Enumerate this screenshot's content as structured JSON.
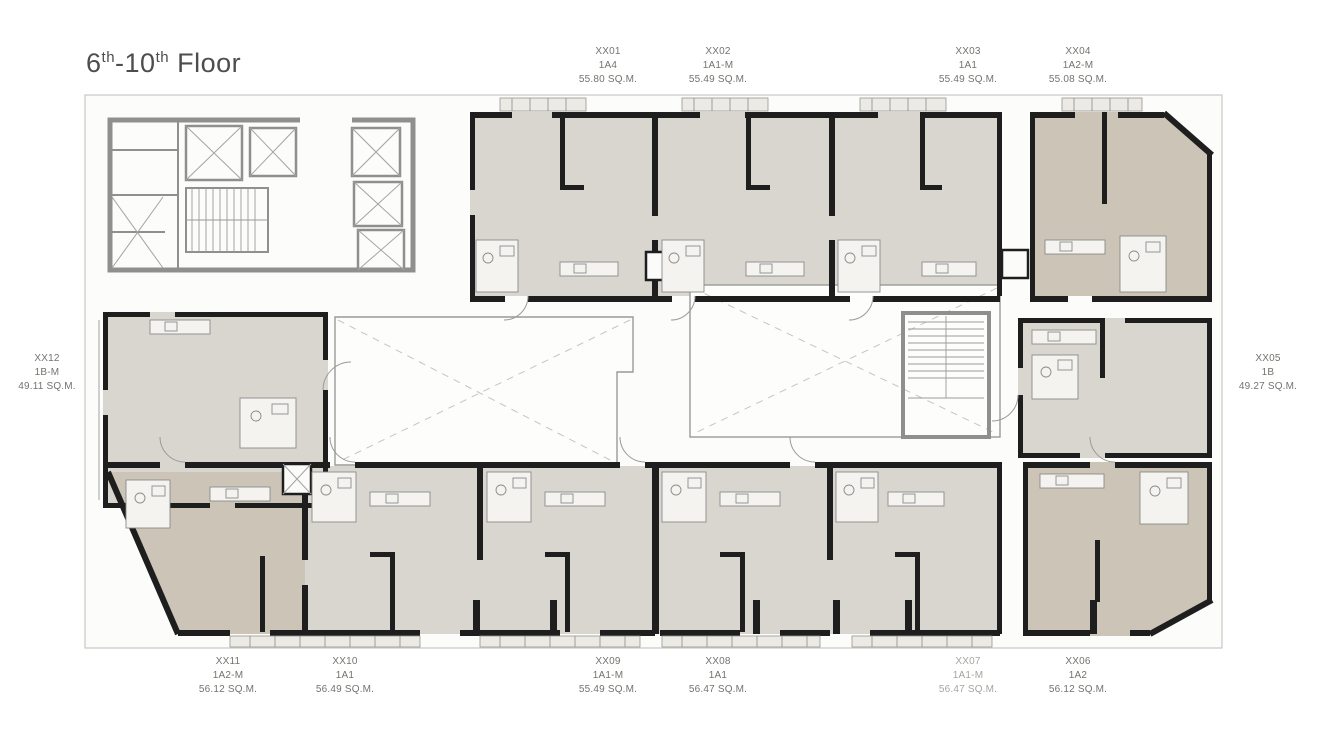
{
  "title": {
    "floor_start": "6",
    "floor_start_sup": "th",
    "floor_mid": "-10",
    "floor_end_sup": "th",
    "floor_word": " Floor"
  },
  "colors": {
    "unit_fill_light": "#d9d6d0",
    "unit_fill_tan": "#cbc4b7",
    "wall": "#1e1e1e",
    "core_wall": "#8f8f8d",
    "label_text": "#73736e",
    "title_text": "#4d4d4b"
  },
  "units": [
    {
      "id": "XX01",
      "type": "1A4",
      "area": "55.80 SQ.M.",
      "side": "top"
    },
    {
      "id": "XX02",
      "type": "1A1-M",
      "area": "55.49 SQ.M.",
      "side": "top"
    },
    {
      "id": "XX03",
      "type": "1A1",
      "area": "55.49 SQ.M.",
      "side": "top"
    },
    {
      "id": "XX04",
      "type": "1A2-M",
      "area": "55.08 SQ.M.",
      "side": "top"
    },
    {
      "id": "XX05",
      "type": "1B",
      "area": "49.27 SQ.M.",
      "side": "right"
    },
    {
      "id": "XX06",
      "type": "1A2",
      "area": "56.12 SQ.M.",
      "side": "bottom"
    },
    {
      "id": "XX07",
      "type": "1A1-M",
      "area": "56.47 SQ.M.",
      "side": "bottom"
    },
    {
      "id": "XX08",
      "type": "1A1",
      "area": "56.47 SQ.M.",
      "side": "bottom"
    },
    {
      "id": "XX09",
      "type": "1A1-M",
      "area": "55.49 SQ.M.",
      "side": "bottom"
    },
    {
      "id": "XX10",
      "type": "1A1",
      "area": "56.49 SQ.M.",
      "side": "bottom"
    },
    {
      "id": "XX11",
      "type": "1A2-M",
      "area": "56.12 SQ.M.",
      "side": "bottom"
    },
    {
      "id": "XX12",
      "type": "1B-M",
      "area": "49.11 SQ.M.",
      "side": "left"
    }
  ]
}
